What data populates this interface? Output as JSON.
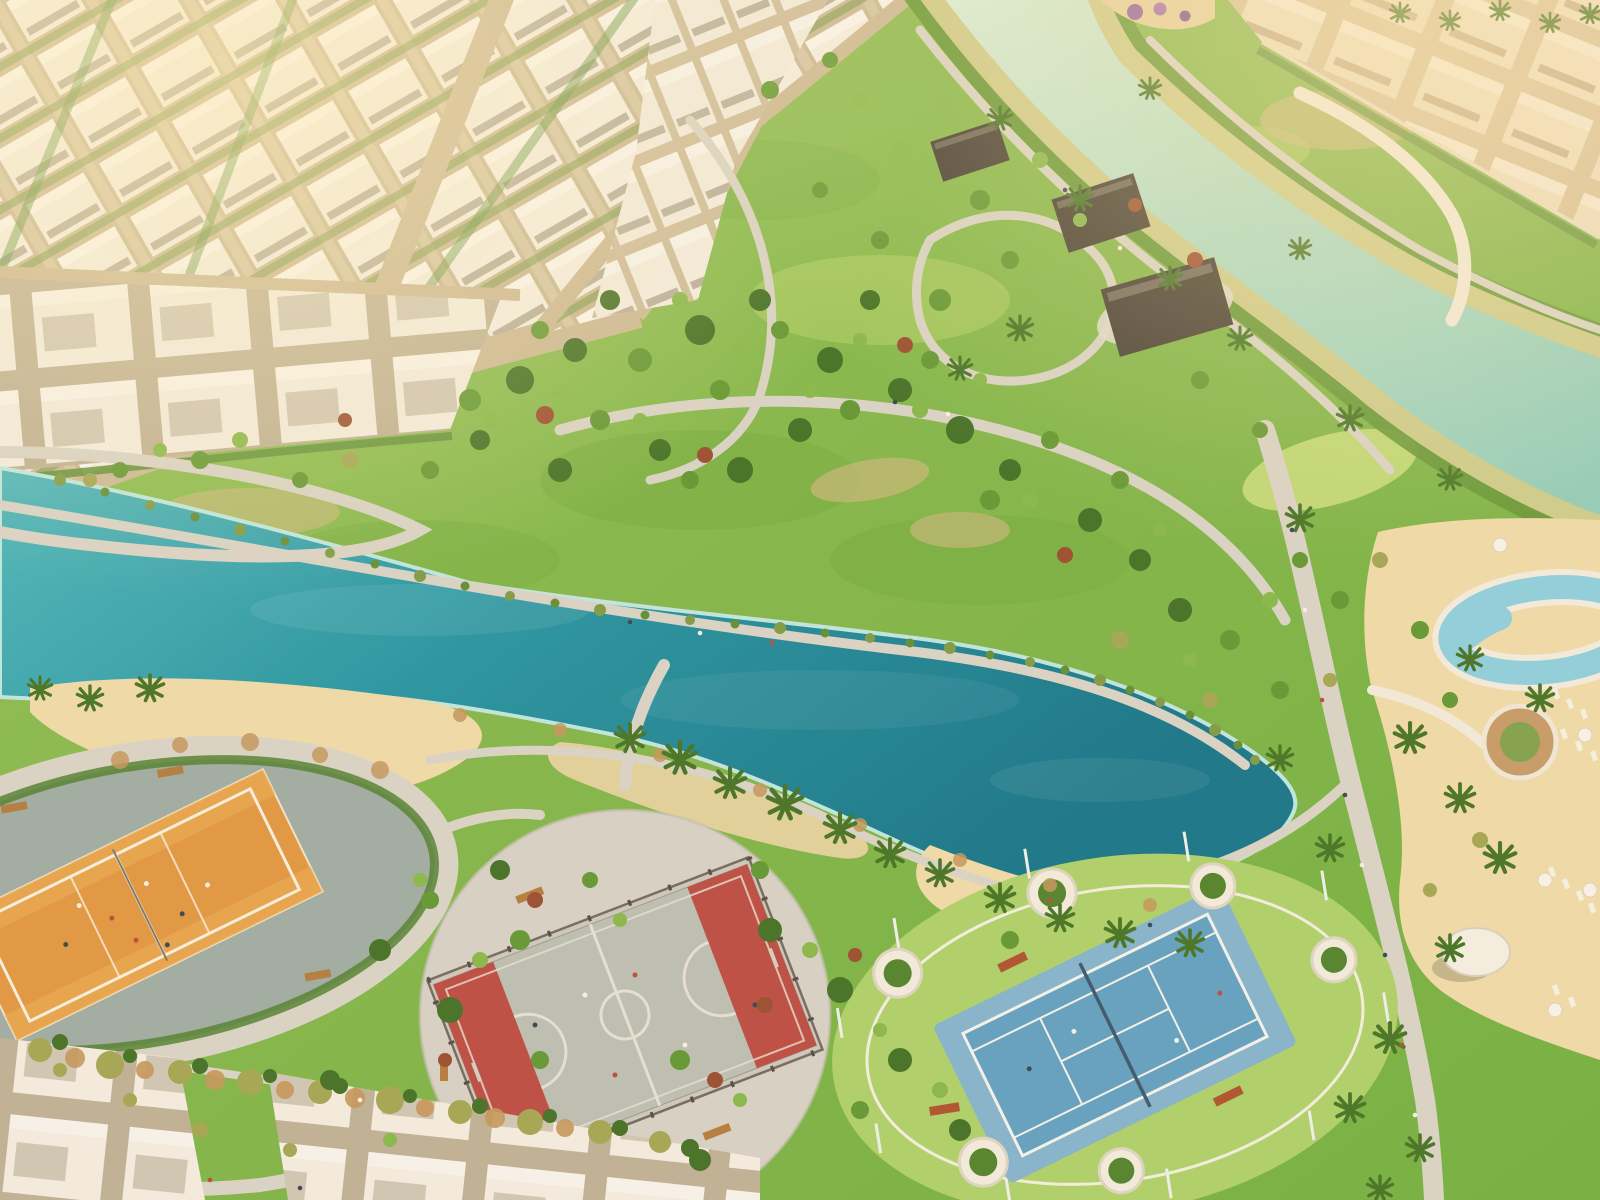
{
  "scene": {
    "type": "aerial-masterplan-render",
    "description": "Golden-hour aerial rendering of a master-planned residential community: white villa districts, a turquoise lagoon lake with sandy beaches, rolling green parkland laced with walking paths, a winding canal, beach-volleyball, basketball and tennis courts, and a resort pool deck lined with palms.",
    "time_of_day": "golden-hour",
    "palette": {
      "grass": "#79b243",
      "grass_light": "#9ac956",
      "lawn_light": "#abd169",
      "lake_deep": "#0f7289",
      "lake_mid": "#1f93a3",
      "lake_light": "#4ab7bd",
      "shallow": "#bce8e1",
      "river": "#abdcc8",
      "sand": "#eedbaa",
      "path": "#d7d3c8",
      "road": "#c9b795",
      "villa_white": "#f3efe6",
      "villa_tan": "#ecddc2",
      "roof_dark": "#413b33",
      "plaza": "#9caba3",
      "plaza_light": "#d5d1c7",
      "court_orange": "#e0953f",
      "court_red": "#c2473f",
      "court_blue": "#5d9fc4",
      "court_blue_light": "#7fb2d0",
      "pool": "#8bd0e0",
      "hedge": "#4c7e2e",
      "tree_dark": "#3d6d22",
      "tree_mid": "#5d9630",
      "tree_light": "#83b748",
      "tree_olive": "#a0a452",
      "tree_red": "#96492d",
      "palm": "#3f7022",
      "deck": "#f1ebdd",
      "glare": "#ffecb4"
    },
    "features": {
      "villa_district": "villa district",
      "townhouse_row": "townhouse row",
      "canal": "canal",
      "lagoon": "lagoon lake",
      "beach": "beach",
      "park": "community park",
      "volleyball_court": "beach volleyball court",
      "basketball_court": "fenced basketball court",
      "tennis_court": "tennis court",
      "pool_deck": "resort pool deck",
      "pavilion": "park pavilion",
      "promenade": "promenade"
    }
  }
}
